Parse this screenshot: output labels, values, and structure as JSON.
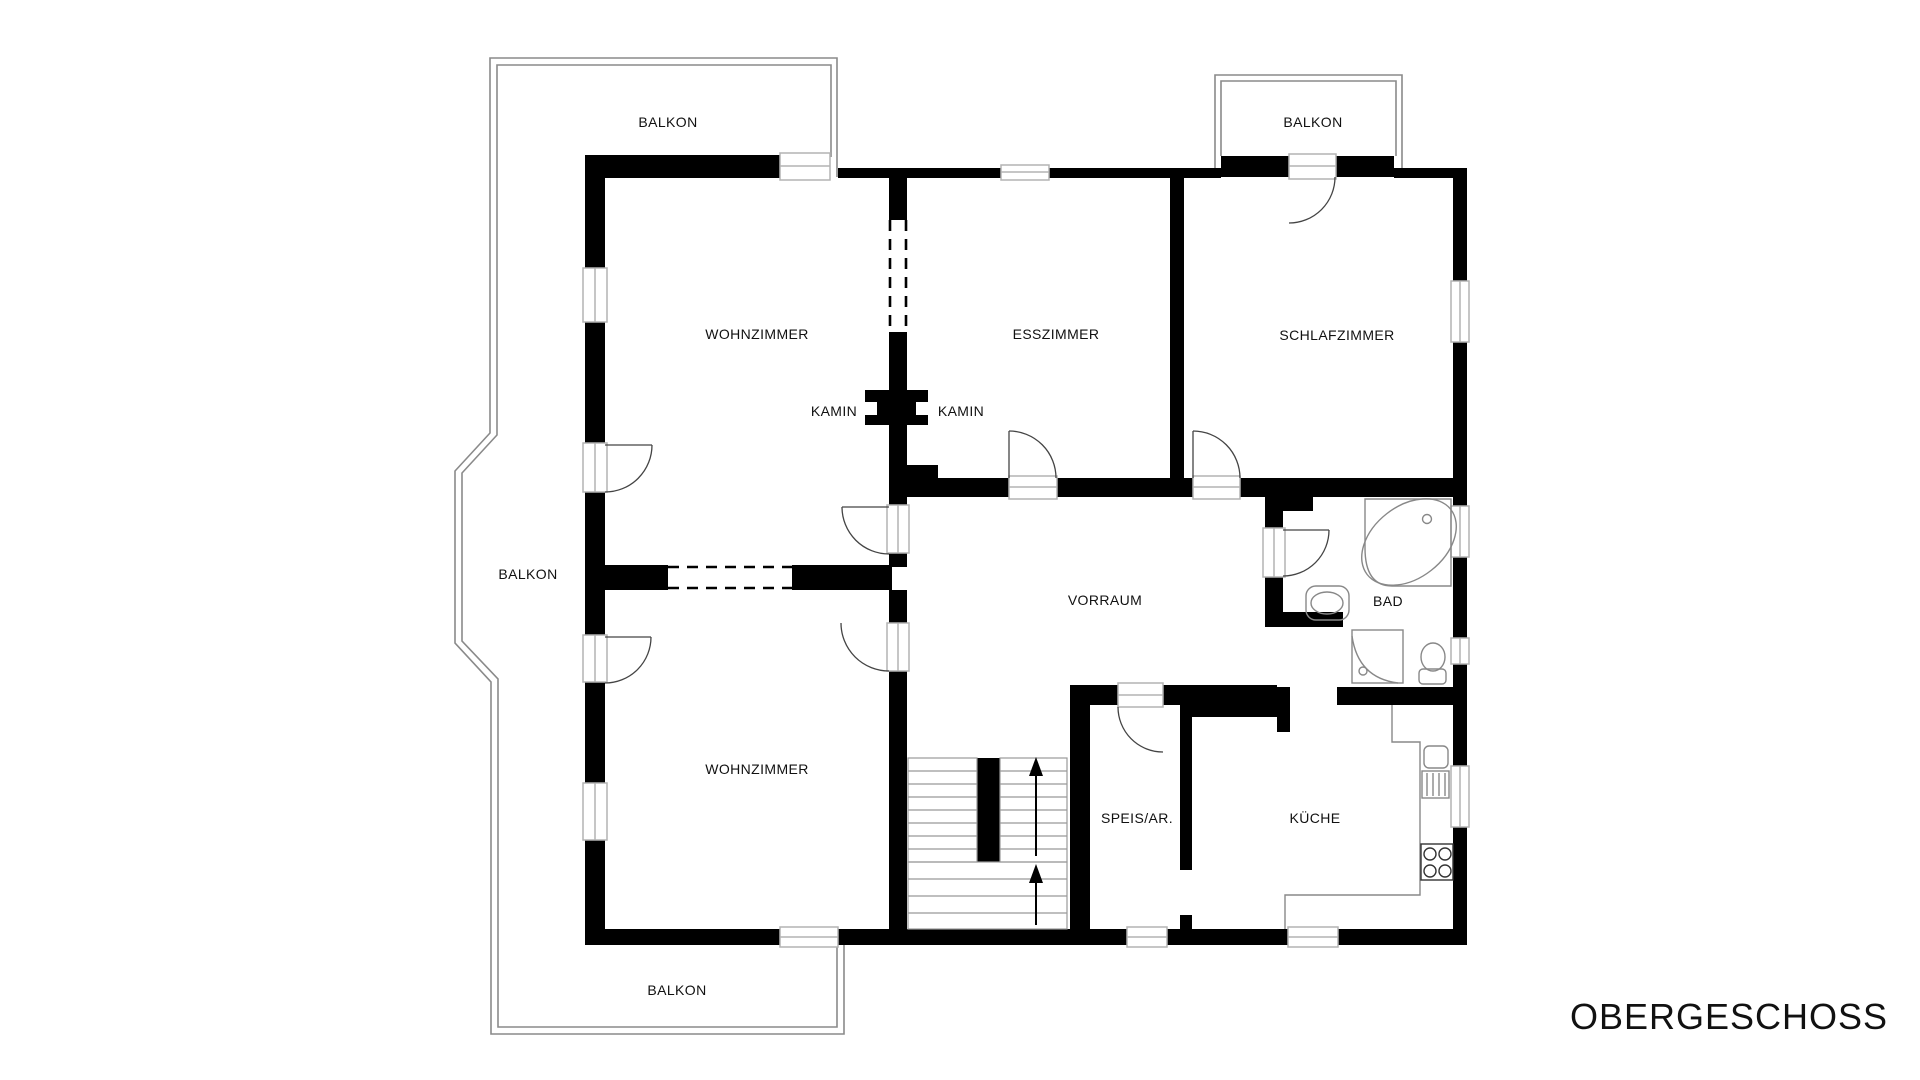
{
  "title": {
    "label": "OBERGESCHOSS"
  },
  "colors": {
    "background": "#ffffff",
    "wall": "#000000",
    "balcony_outline": "#8a8a8a",
    "opening_frame": "#b3b3b3",
    "fixture_line": "#888888",
    "stair_line": "#999999",
    "door_arc": "#444444",
    "text": "#111111"
  },
  "floor_plan": {
    "floor_name": "OBERGESCHOSS",
    "rooms": [
      {
        "id": "balkon-top-left",
        "label": "BALKON",
        "x": 668,
        "y": 122
      },
      {
        "id": "balkon-top-right",
        "label": "BALKON",
        "x": 1313,
        "y": 122
      },
      {
        "id": "wohnzimmer-top",
        "label": "WOHNZIMMER",
        "x": 757,
        "y": 334
      },
      {
        "id": "esszimmer",
        "label": "ESSZIMMER",
        "x": 1056,
        "y": 334
      },
      {
        "id": "schlafzimmer",
        "label": "SCHLAFZIMMER",
        "x": 1337,
        "y": 335
      },
      {
        "id": "kamin-left",
        "label": "KAMIN",
        "x": 834,
        "y": 411
      },
      {
        "id": "kamin-right",
        "label": "KAMIN",
        "x": 961,
        "y": 411
      },
      {
        "id": "balkon-left",
        "label": "BALKON",
        "x": 528,
        "y": 574
      },
      {
        "id": "vorraum",
        "label": "VORRAUM",
        "x": 1105,
        "y": 600
      },
      {
        "id": "bad",
        "label": "BAD",
        "x": 1388,
        "y": 601
      },
      {
        "id": "wohnzimmer-bottom",
        "label": "WOHNZIMMER",
        "x": 757,
        "y": 769
      },
      {
        "id": "speis-ar",
        "label": "SPEIS/AR.",
        "x": 1137,
        "y": 818
      },
      {
        "id": "kueche",
        "label": "KÜCHE",
        "x": 1315,
        "y": 818
      },
      {
        "id": "balkon-bottom",
        "label": "BALKON",
        "x": 677,
        "y": 990
      }
    ]
  }
}
